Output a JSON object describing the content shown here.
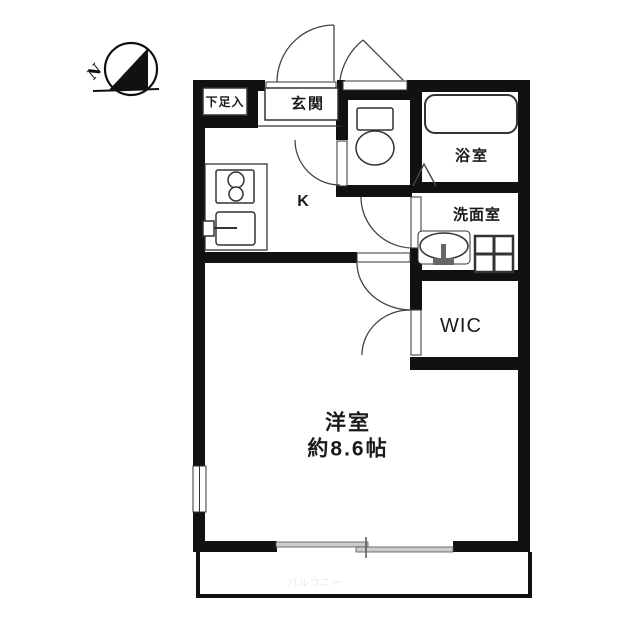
{
  "floorplan": {
    "compass": {
      "label": "N"
    },
    "rooms": {
      "shoe_storage": "下足入",
      "entrance": "玄関",
      "bathroom": "浴室",
      "washroom": "洗面室",
      "kitchen": "K",
      "wic": "WIC",
      "main_room_name": "洋室",
      "main_room_size": "約8.6帖",
      "balcony": "バルコニー"
    },
    "colors": {
      "wall": "#111111",
      "line": "#333333",
      "door_arc": "#444444",
      "slider_fill": "#cccccc",
      "faint_text": "#e8e8e8"
    }
  }
}
